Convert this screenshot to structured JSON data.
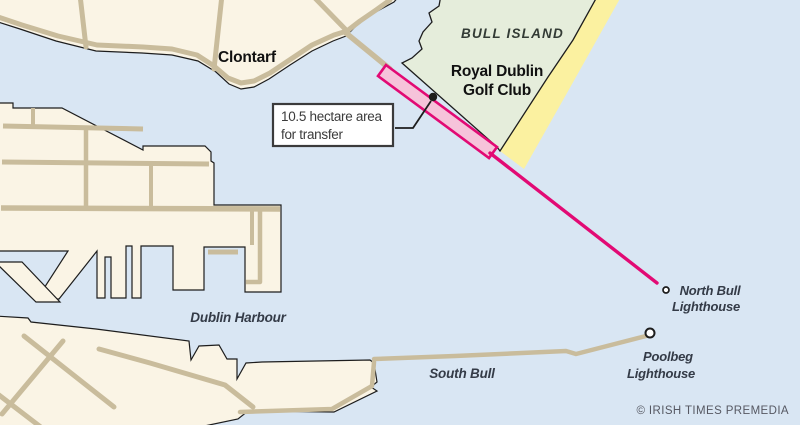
{
  "map": {
    "places": {
      "clontarf": "Clontarf",
      "bull_island": "BULL ISLAND",
      "golf_club_line1": "Royal Dublin",
      "golf_club_line2": "Golf Club",
      "dublin_harbour": "Dublin Harbour",
      "south_bull": "South Bull",
      "north_bull_lighthouse_line1": "North Bull",
      "north_bull_lighthouse_line2": "Lighthouse",
      "poolbeg_lighthouse_line1": "Poolbeg",
      "poolbeg_lighthouse_line2": "Lighthouse"
    },
    "callout": {
      "line1": "10.5 hectare area",
      "line2": "for transfer"
    },
    "credit": "© IRISH TIMES PREMEDIA",
    "colors": {
      "water": "#D9E6F3",
      "land": "#FAF4E5",
      "road": "#C9BC9C",
      "outline": "#1d1d1d",
      "island_green": "#E5EDDB",
      "beach_yellow": "#FBF1A0",
      "transfer_pink_fill": "#F6C3DA",
      "transfer_pink_stroke": "#E20A74",
      "label_dark": "#111111",
      "water_label_color": "#343B47",
      "island_label_color": "#333B35",
      "callout_text_color": "#3B3B3B",
      "credit_gray": "#565862",
      "marker_white": "#FFFFFF"
    }
  }
}
